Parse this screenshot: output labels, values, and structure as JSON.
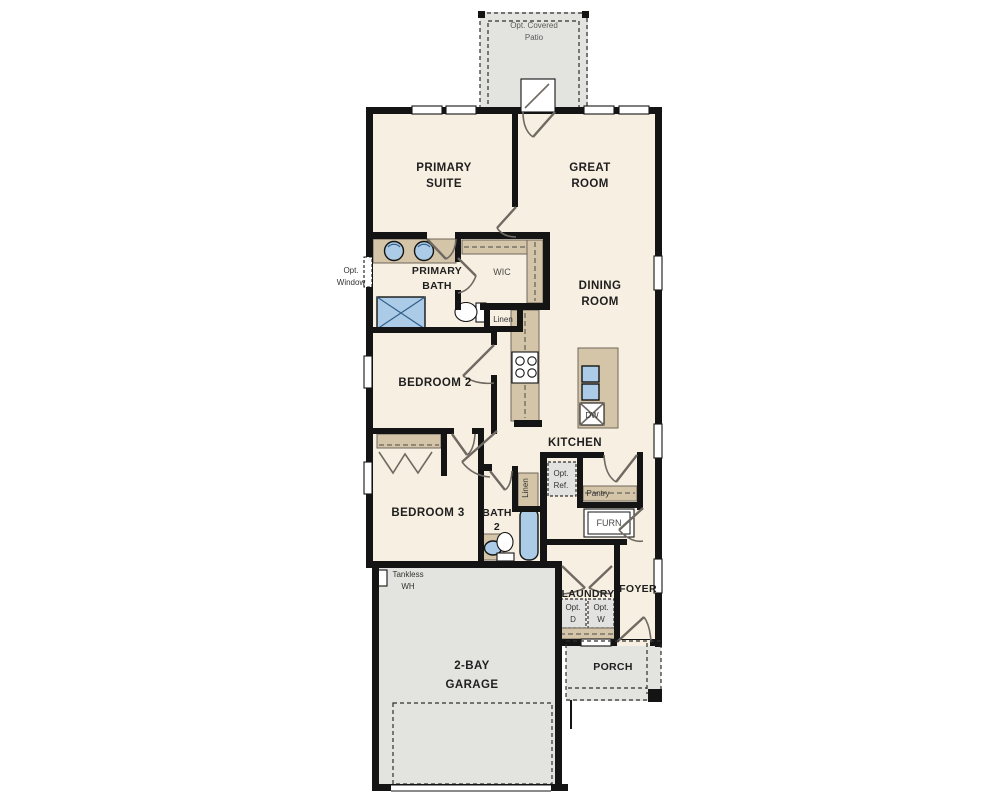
{
  "plan_title": "single-story floor plan",
  "colors": {
    "floor": "#f7efe1",
    "wall": "#141414",
    "counter": "#d4c5a8",
    "counter_edge": "#6f675c",
    "fixture": "#abcbe6",
    "fixture_edge": "#2f5d8a",
    "concrete": "#e3e3e0",
    "appliance": "#e2e2e0",
    "door": "#6f6962",
    "label": "#1f1f1f"
  },
  "rooms": {
    "patio": {
      "line1": "Opt. Covered",
      "line2": "Patio"
    },
    "primary_suite": {
      "line1": "PRIMARY",
      "line2": "SUITE"
    },
    "great_room": {
      "line1": "GREAT",
      "line2": "ROOM"
    },
    "opt_window": {
      "line1": "Opt.",
      "line2": "Window"
    },
    "primary_bath": {
      "line1": "PRIMARY",
      "line2": "BATH"
    },
    "wic": {
      "label": "WIC"
    },
    "linen_bath": {
      "label": "Linen"
    },
    "dining_room": {
      "line1": "DINING",
      "line2": "ROOM"
    },
    "bedroom2": {
      "label": "BEDROOM 2"
    },
    "kitchen": {
      "label": "KITCHEN"
    },
    "dishwasher": {
      "label": "DW"
    },
    "opt_ref": {
      "line1": "Opt.",
      "line2": "Ref."
    },
    "linen_hall": {
      "label": "Linen"
    },
    "pantry": {
      "label": "Pantry"
    },
    "bedroom3": {
      "label": "BEDROOM 3"
    },
    "bath2": {
      "line1": "BATH",
      "line2": "2"
    },
    "furnace": {
      "label": "FURN"
    },
    "tankless": {
      "line1": "Tankless",
      "line2": "WH"
    },
    "laundry": {
      "label": "LAUNDRY"
    },
    "opt_dryer": {
      "line1": "Opt.",
      "line2": "D"
    },
    "opt_washer": {
      "line1": "Opt.",
      "line2": "W"
    },
    "foyer": {
      "label": "FOYER"
    },
    "garage": {
      "line1": "2-BAY",
      "line2": "GARAGE"
    },
    "porch": {
      "label": "PORCH"
    }
  }
}
